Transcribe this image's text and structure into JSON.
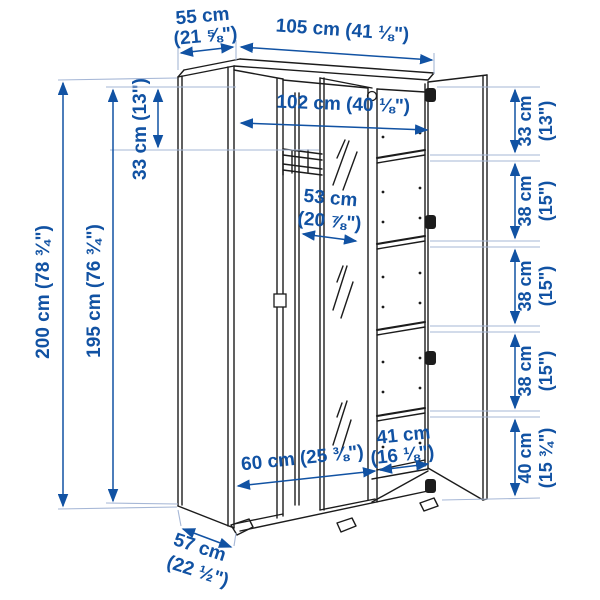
{
  "diagram_type": "wardrobe dimension drawing",
  "colors": {
    "dimension_blue": "#1152a3",
    "extension_line_blue": "#a6b7d6",
    "line_art_black": "#1c1c1c",
    "background": "#ffffff"
  },
  "dims": {
    "depth_top": {
      "cm": "55 cm",
      "in": "(21 ⅝\")"
    },
    "width_total": "105 cm (41 ⅛\")",
    "width_interior": "102 cm (40 ⅛\")",
    "rail_from_top": "33 cm (13\")",
    "height_total": "200 cm (78 ¾\")",
    "height_interior": "195 cm (76 ¾\")",
    "mirror_door_width": {
      "cm": "53 cm",
      "in": "(20 ⅞\")"
    },
    "left_section_width": "60 cm (25 ⅜\")",
    "right_section_width": {
      "cm": "41 cm",
      "in": "(16 ⅛\")"
    },
    "depth_total": {
      "cm": "57 cm",
      "in": "(22 ½\")"
    },
    "shelf_column": [
      {
        "cm": "33 cm",
        "in": "(13\")"
      },
      {
        "cm": "38 cm",
        "in": "(15\")"
      },
      {
        "cm": "38 cm",
        "in": "(15\")"
      },
      {
        "cm": "38 cm",
        "in": "(15\")"
      },
      {
        "cm": "40 cm",
        "in": "(15 ¾\")"
      }
    ]
  }
}
